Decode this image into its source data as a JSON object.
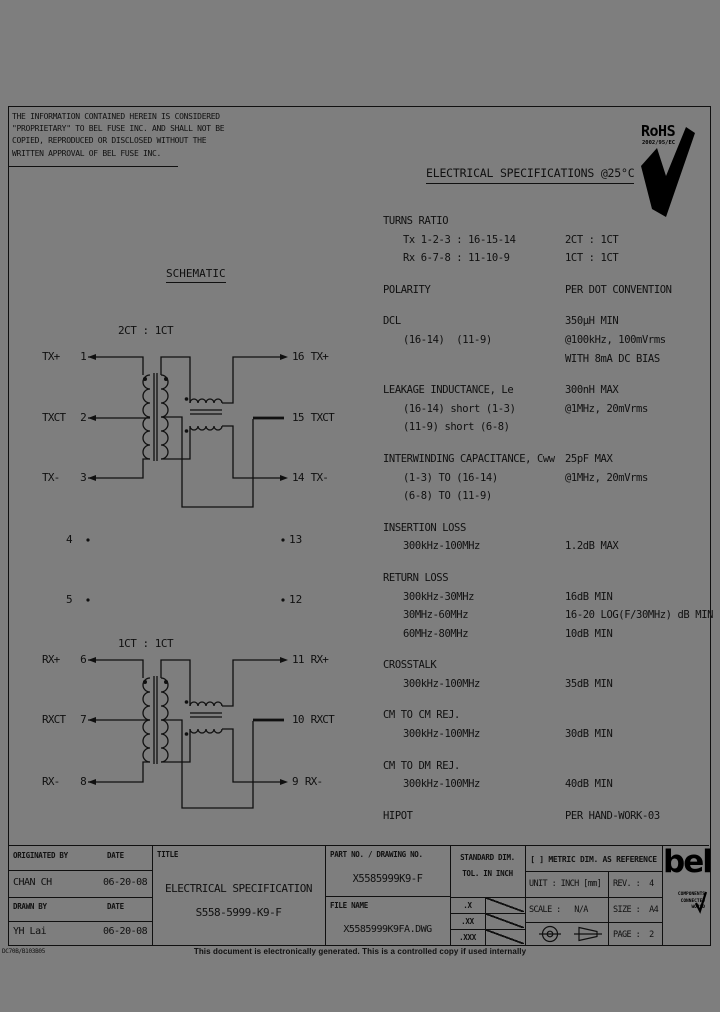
{
  "page": {
    "footer_note": "This document is electronically generated. This is a controlled copy if used internally",
    "doc_code": "DC70B/B103B05",
    "bg_color": "#7e7e7e",
    "line_color": "#101010"
  },
  "proprietary_notice": {
    "line1": "THE INFORMATION CONTAINED HEREIN IS CONSIDERED",
    "line2": "\"PROPRIETARY\" TO BEL FUSE INC. AND SHALL NOT BE",
    "line3": "COPIED, REPRODUCED OR DISCLOSED WITHOUT THE",
    "line4": "WRITTEN APPROVAL OF BEL FUSE INC."
  },
  "rohs": {
    "label": "RoHS",
    "directive": "2002/95/EC"
  },
  "header": {
    "title": "ELECTRICAL SPECIFICATIONS @25°C"
  },
  "schematic": {
    "caption": "SCHEMATIC",
    "tx": {
      "ratio": "2CT : 1CT",
      "left_pins": [
        {
          "label": "TX+",
          "num": "1"
        },
        {
          "label": "TXCT",
          "num": "2"
        },
        {
          "label": "TX-",
          "num": "3"
        }
      ],
      "right_pins": [
        {
          "num": "16",
          "label": "TX+"
        },
        {
          "num": "15",
          "label": "TXCT"
        },
        {
          "num": "14",
          "label": "TX-"
        }
      ]
    },
    "rx": {
      "ratio": "1CT : 1CT",
      "left_pins": [
        {
          "label": "RX+",
          "num": "6"
        },
        {
          "label": "RXCT",
          "num": "7"
        },
        {
          "label": "RX-",
          "num": "8"
        }
      ],
      "right_pins": [
        {
          "num": "11",
          "label": "RX+"
        },
        {
          "num": "10",
          "label": "RXCT"
        },
        {
          "num": "9",
          "label": "RX-"
        }
      ]
    },
    "nc_pins": {
      "left": [
        "4",
        "5"
      ],
      "right": [
        "13",
        "12"
      ]
    }
  },
  "specs": {
    "sections": [
      {
        "title": "TURNS RATIO",
        "value": "",
        "rows": [
          {
            "param": "Tx 1-2-3 : 16-15-14",
            "value": "2CT : 1CT"
          },
          {
            "param": "Rx 6-7-8 : 11-10-9",
            "value": "1CT : 1CT"
          }
        ]
      },
      {
        "title": "POLARITY",
        "value": "PER DOT CONVENTION",
        "rows": []
      },
      {
        "title": "DCL",
        "value": "350µH MIN",
        "rows": [
          {
            "param": "(16-14)  (11-9)",
            "value": "@100kHz, 100mVrms"
          },
          {
            "param": "",
            "value": "WITH 8mA DC BIAS"
          }
        ]
      },
      {
        "title": "LEAKAGE INDUCTANCE, Le",
        "value": "300nH MAX",
        "rows": [
          {
            "param": "(16-14) short (1-3)",
            "value": "@1MHz, 20mVrms"
          },
          {
            "param": "(11-9) short (6-8)",
            "value": ""
          }
        ]
      },
      {
        "title": "INTERWINDING CAPACITANCE, Cww",
        "value": "25pF MAX",
        "rows": [
          {
            "param": "(1-3) TO (16-14)",
            "value": "@1MHz, 20mVrms"
          },
          {
            "param": "(6-8) TO (11-9)",
            "value": ""
          }
        ]
      },
      {
        "title": "INSERTION LOSS",
        "value": "",
        "rows": [
          {
            "param": "300kHz-100MHz",
            "value": "1.2dB MAX"
          }
        ]
      },
      {
        "title": "RETURN LOSS",
        "value": "",
        "rows": [
          {
            "param": "300kHz-30MHz",
            "value": "16dB MIN"
          },
          {
            "param": "30MHz-60MHz",
            "value": "16-20 LOG(F/30MHz) dB MIN"
          },
          {
            "param": "60MHz-80MHz",
            "value": "10dB MIN"
          }
        ]
      },
      {
        "title": "CROSSTALK",
        "value": "",
        "rows": [
          {
            "param": "300kHz-100MHz",
            "value": "35dB MIN"
          }
        ]
      },
      {
        "title": "CM TO CM REJ.",
        "value": "",
        "rows": [
          {
            "param": "300kHz-100MHz",
            "value": "30dB MIN"
          }
        ]
      },
      {
        "title": "CM TO DM REJ.",
        "value": "",
        "rows": [
          {
            "param": "300kHz-100MHz",
            "value": "40dB MIN"
          }
        ]
      },
      {
        "title": "HIPOT",
        "value": "PER HAND-WORK-03",
        "rows": []
      }
    ]
  },
  "title_block": {
    "originated_by_label": "ORIGINATED BY",
    "date_label": "DATE",
    "originated_by": "CHAN CH",
    "originated_date": "06-20-08",
    "drawn_by_label": "DRAWN BY",
    "date_label2": "DATE",
    "drawn_by": "YH Lai",
    "drawn_date": "06-20-08",
    "title_label": "TITLE",
    "title_line1": "ELECTRICAL SPECIFICATION",
    "title_line2": "S558-5999-K9-F",
    "part_no_label": "PART NO. / DRAWING NO.",
    "part_no": "X5585999K9-F",
    "file_name_label": "FILE NAME",
    "file_name": "X5585999K9FA.DWG",
    "std_dim_label1": "STANDARD DIM.",
    "std_dim_label2": "TOL. IN INCH",
    "tol_rows": [
      ".X",
      ".XX",
      ".XXX"
    ],
    "metric_note": "[ ] METRIC DIM. AS REFERENCE",
    "unit_label": "UNIT : INCH [mm]",
    "rev_label": "REV. :",
    "rev": "4",
    "scale_label": "SCALE :",
    "scale": "N/A",
    "size_label": "SIZE :",
    "size": "A4",
    "page_label": "PAGE :",
    "page": "2",
    "bel_logo": "bel",
    "bel_tagline1": "COMPONENTS",
    "bel_tagline2": "CONNECTED",
    "bel_tagline3": "WORLD"
  }
}
